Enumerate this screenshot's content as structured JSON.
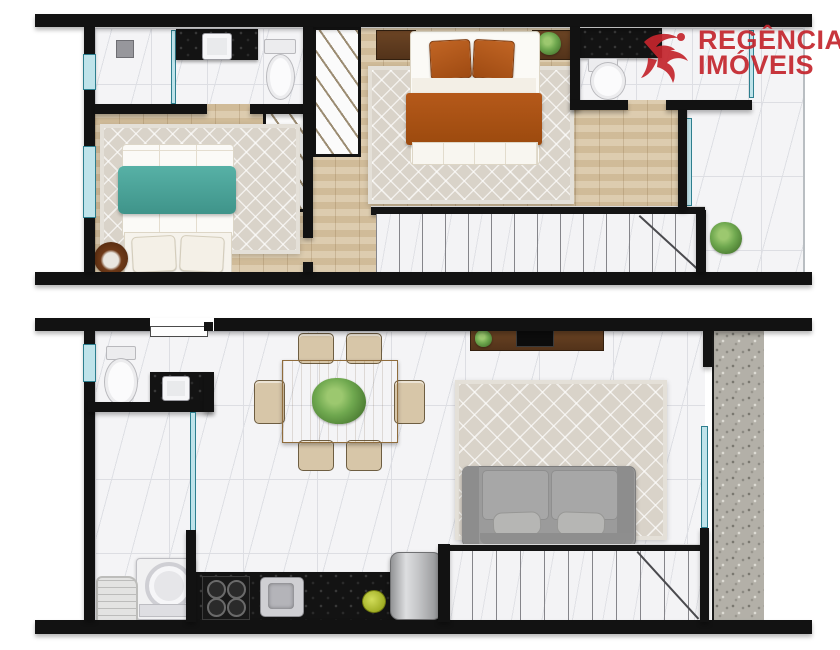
{
  "logo": {
    "line1": "REGÊNCIA",
    "line2": "IMÓVEIS",
    "color": "#c4252d",
    "icon": "abstract-red-figure"
  },
  "colors": {
    "wall": "#121212",
    "wood_floor": "#d8c5a4",
    "marble_tile": "#f4f4f6",
    "rug_beige": "#d9d3c9",
    "bed_teal": "#4aa59b",
    "bed_orange": "#ad5312",
    "counter_black": "#131313",
    "sofa_gray": "#9b9b9b",
    "glass_blue": "#bfe3ea",
    "gravel_gray": "#b3b0a8",
    "plant_green": "#6fa84f",
    "logo_red": "#c4252d"
  },
  "floors": [
    {
      "id": "upper-floor",
      "elements": [
        "bathroom with shower, black vanity with sink and toilet",
        "bedroom with teal double bed, area rug and round pet bed",
        "two wardrobes with hanging rails",
        "master bedroom with orange double bed, two wood nightstands and plant",
        "second bathroom with black vanity and toilet",
        "balcony with potted plant and glass door",
        "staircase with railing"
      ]
    },
    {
      "id": "lower-floor",
      "elements": [
        "entrance door",
        "powder room with toilet and black vanity",
        "wood dining table with six chairs and centerpiece plant",
        "wood TV console with TV and plant",
        "living room area rug and gray two-seat sofa",
        "gravel side-yard strip with glass door",
        "laundry corner with washing machine and basket",
        "black kitchen counter with gas cooktop, sink and fruit bowl",
        "refrigerator",
        "staircase with railing"
      ]
    }
  ]
}
